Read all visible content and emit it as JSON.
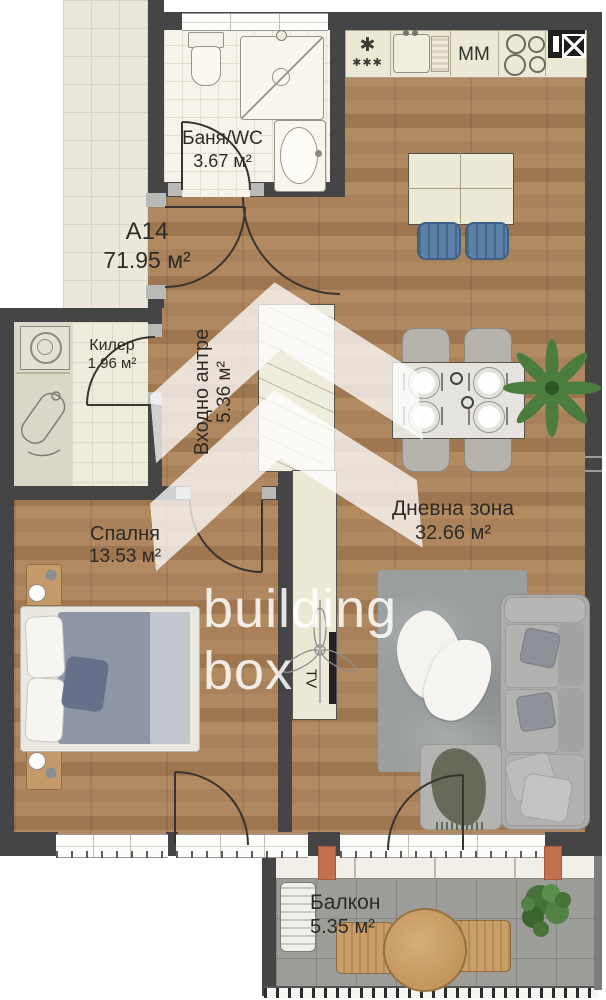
{
  "plan": {
    "unit": {
      "label": "A14",
      "area": "71.95 м²"
    },
    "rooms": {
      "bathroom": {
        "name": "Баня/WC",
        "area": "3.67 м²"
      },
      "storage": {
        "name": "Килер",
        "area": "1.96 м²"
      },
      "hallway": {
        "name": "Входно антре",
        "area": "5.36 м²"
      },
      "living": {
        "name": "Дневна зона",
        "area": "32.66 м²"
      },
      "bedroom": {
        "name": "Спалня",
        "area": "13.53 м²"
      },
      "balcony": {
        "name": "Балкон",
        "area": "5.35 м²"
      }
    },
    "appliances": {
      "microwave_label": "MM",
      "tv_label": "TV",
      "fridge_star": "✱",
      "fridge_stars": "✱✱✱"
    },
    "watermark": {
      "line1": "building",
      "line2": "box"
    },
    "colors": {
      "wall": "#454545",
      "wood": "#a9815a",
      "corridor_tile": "#ebe8db",
      "balcony_floor": "#9c9c99",
      "cabinet_beige": "#ece8d6",
      "chair_blue": "#5d80a8",
      "sofa_gray": "#acacaa",
      "plant_green": "#4b7d3e",
      "accent_terracotta": "#c4714f",
      "door_arc": "#3a3430"
    }
  }
}
